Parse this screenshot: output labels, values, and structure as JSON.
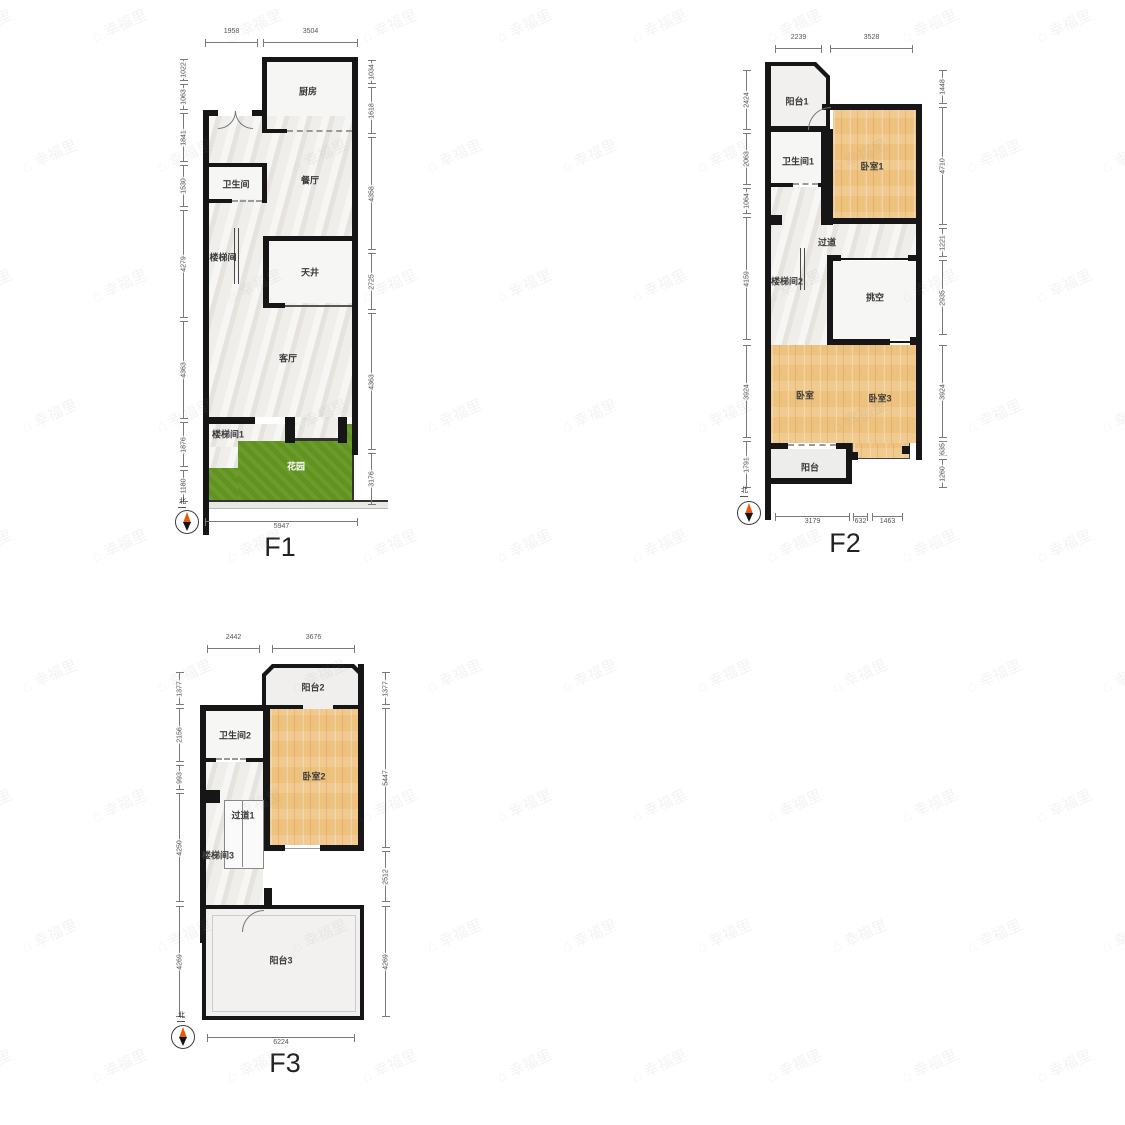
{
  "watermark": "幸福里",
  "compass": {
    "north_label": "北"
  },
  "floors": {
    "f1": {
      "label": "F1",
      "rooms": {
        "kitchen": "厨房",
        "bath": "卫生间",
        "dining": "餐厅",
        "stair": "楼梯间",
        "lightwell": "天井",
        "living": "客厅",
        "stair1": "楼梯间1",
        "garden": "花园"
      },
      "dims": {
        "top": [
          "1958",
          "3504"
        ],
        "left": [
          "1022",
          "1063",
          "1841",
          "1530",
          "4279",
          "4363",
          "1876",
          "1180"
        ],
        "right": [
          "1034",
          "1618",
          "4358",
          "2725",
          "4363",
          "3176"
        ],
        "bottom": [
          "5947"
        ]
      }
    },
    "f2": {
      "label": "F2",
      "rooms": {
        "balcony1": "阳台1",
        "bath1": "卫生间1",
        "bedroom1": "卧室1",
        "corridor": "过道",
        "stair2": "楼梯间2",
        "void": "挑空",
        "bedroom": "卧室",
        "bedroom3": "卧室3",
        "balcony": "阳台"
      },
      "dims": {
        "top": [
          "2239",
          "3528"
        ],
        "left": [
          "2424",
          "2063",
          "1064",
          "4159",
          "3924",
          "1791"
        ],
        "right": [
          "1448",
          "4710",
          "1221",
          "2935",
          "3924",
          "635",
          "1260"
        ],
        "bottom": [
          "3179",
          "632",
          "1463"
        ]
      }
    },
    "f3": {
      "label": "F3",
      "rooms": {
        "balcony2": "阳台2",
        "bath2": "卫生间2",
        "bedroom2": "卧室2",
        "corridor1": "过道1",
        "stair3": "楼梯间3",
        "balcony3": "阳台3"
      },
      "dims": {
        "top": [
          "2442",
          "3676"
        ],
        "left": [
          "1377",
          "2156",
          "993",
          "4250",
          "4269"
        ],
        "right": [
          "1377",
          "5447",
          "2512",
          "4269"
        ],
        "bottom": [
          "6224"
        ]
      }
    }
  }
}
